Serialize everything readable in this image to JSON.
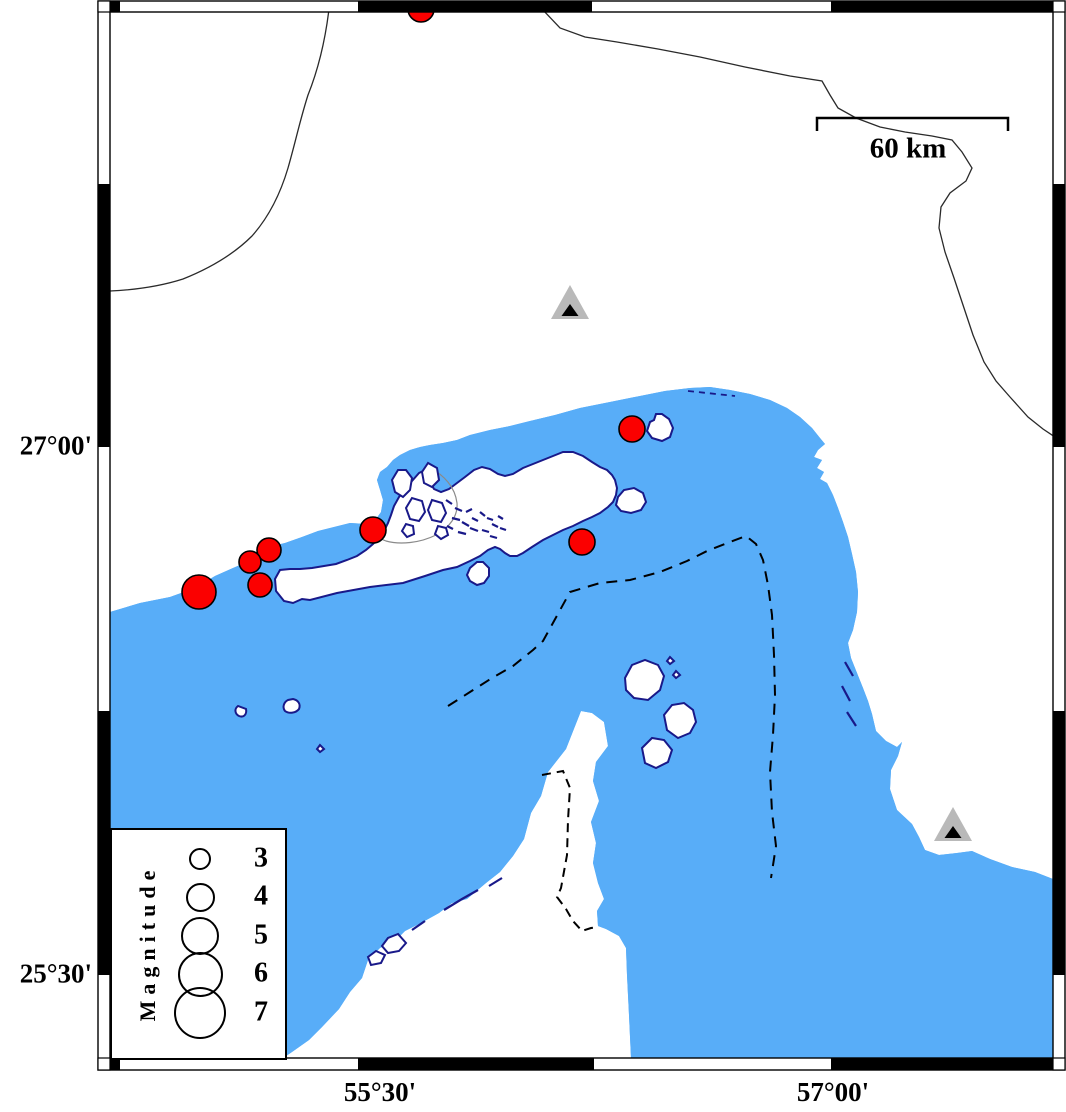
{
  "map": {
    "axis": {
      "left": [
        {
          "label": "27°00'",
          "y": 447
        },
        {
          "label": "25°30'",
          "y": 975
        }
      ],
      "bottom": [
        {
          "label": "55°30'",
          "x": 380
        },
        {
          "label": "57°00'",
          "x": 833
        }
      ]
    },
    "scalebar": {
      "label": "60 km",
      "x1": 817,
      "x2": 1008,
      "y": 118,
      "tick_h": 13,
      "label_x": 908,
      "label_y": 149
    },
    "legend": {
      "title": "Magnitude",
      "circle_cx": 88,
      "number_cx": 149,
      "entries": [
        {
          "magnitude": "3",
          "cy": 29,
          "r": 11
        },
        {
          "magnitude": "4",
          "cy": 67,
          "r": 14.5
        },
        {
          "magnitude": "5",
          "cy": 106,
          "r": 19
        },
        {
          "magnitude": "6",
          "cy": 144,
          "r": 22.5
        },
        {
          "magnitude": "7",
          "cy": 183,
          "r": 26
        }
      ]
    },
    "earthquakes": [
      {
        "x": 421,
        "y": 9,
        "r": 13
      },
      {
        "x": 632,
        "y": 429,
        "r": 13
      },
      {
        "x": 582,
        "y": 542,
        "r": 13
      },
      {
        "x": 373,
        "y": 530,
        "r": 13
      },
      {
        "x": 269,
        "y": 550,
        "r": 12
      },
      {
        "x": 250,
        "y": 562,
        "r": 11
      },
      {
        "x": 260,
        "y": 585,
        "r": 12
      },
      {
        "x": 199,
        "y": 592,
        "r": 17
      }
    ],
    "stations": [
      {
        "x": 570,
        "y": 307
      },
      {
        "x": 953,
        "y": 829
      }
    ],
    "colors": {
      "sea": "#58adf8",
      "land": "#ffffff",
      "coast": "#191989",
      "earthquake_fill": "#fb0000",
      "earthquake_stroke": "#000000",
      "station_outer": "#b9b9b9",
      "station_inner": "#000000",
      "frame": "#000000"
    }
  }
}
